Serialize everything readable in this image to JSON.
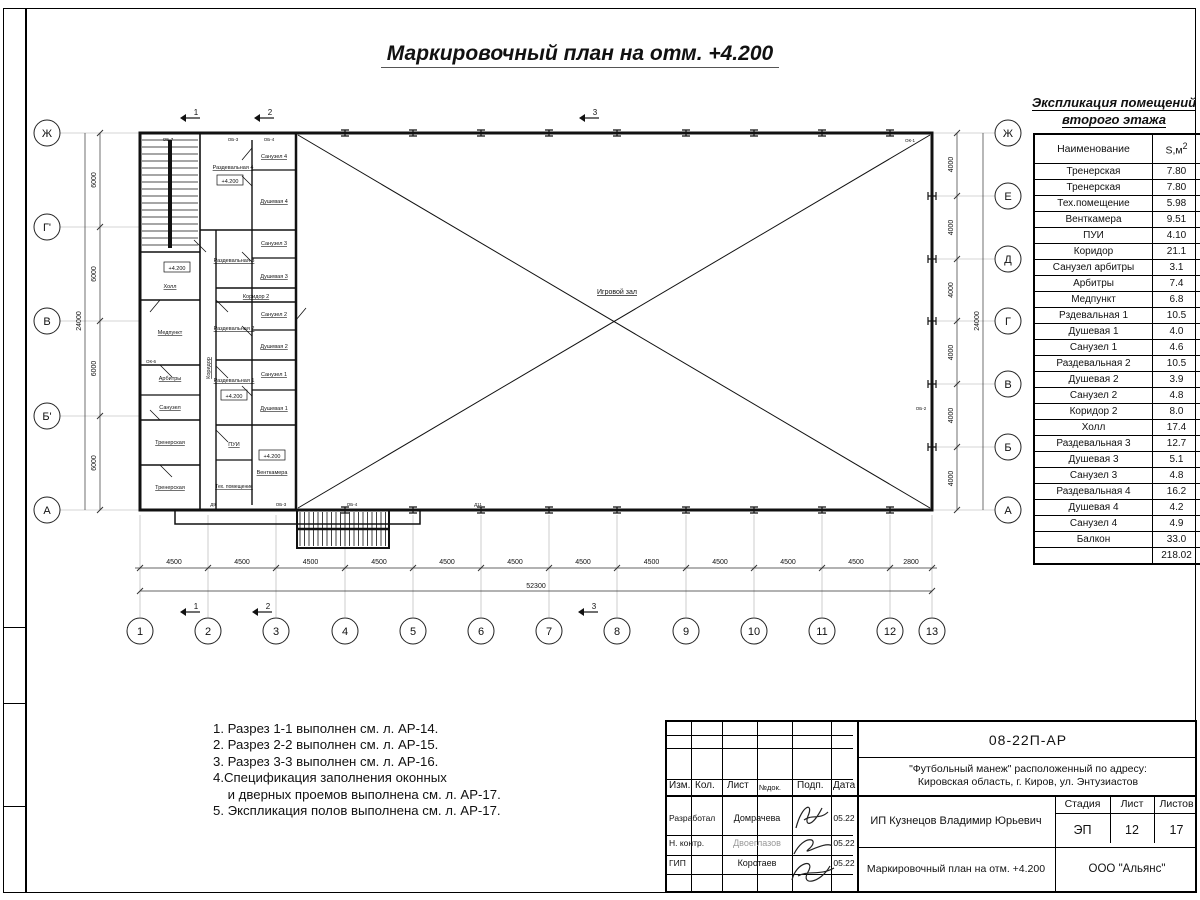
{
  "title": "Маркировочный план на отм. +4.200",
  "plan": {
    "hall_label": "Игровой зал",
    "elevation": "+4.200",
    "rooms": {
      "razd4": "Раздевальная 4",
      "san4": "Санузел 4",
      "dush4": "Душевая 4",
      "razd3": "Раздевальная 3",
      "san3": "Санузел 3",
      "dush3": "Душевая 3",
      "koridor2": "Коридор 2",
      "razd2": "Раздевальная 2",
      "san2": "Санузел 2",
      "dush2": "Душевая 2",
      "razd1": "Раздевальная 1",
      "san1": "Санузел 1",
      "dush1": "Душевая 1",
      "holl": "Холл",
      "medpunkt": "Медпункт",
      "arbitry": "Арбитры",
      "sanuzel": "Санузел",
      "trener1": "Тренерская",
      "trener2": "Тренерская",
      "koridor": "Коридор",
      "pui": "ПУИ",
      "teh": "Тех. помещение",
      "ventkamera": "Венткамера"
    },
    "marks": {
      "m1": "ОБ-7",
      "m2": "ОБ-3",
      "m3": "ОБ-4",
      "m4": "ОК-1",
      "m5": "ОБ-2",
      "m6": "ОК-6",
      "m7": "Д9",
      "m8": "ОБ-3",
      "m9": "ОБ-4",
      "m10": "Д11"
    },
    "axes_bottom": [
      "1",
      "2",
      "3",
      "4",
      "5",
      "6",
      "7",
      "8",
      "9",
      "10",
      "11",
      "12",
      "13"
    ],
    "axes_left": [
      "Ж",
      "Г'",
      "В",
      "Б'",
      "А"
    ],
    "axes_right": [
      "Ж",
      "Е",
      "Д",
      "Г",
      "В",
      "Б",
      "А"
    ],
    "dims_bottom": [
      "4500",
      "4500",
      "4500",
      "4500",
      "4500",
      "4500",
      "4500",
      "4500",
      "4500",
      "4500",
      "4500",
      "2800"
    ],
    "dim_total_bottom": "52300",
    "dims_left": [
      "6000",
      "6000",
      "6000",
      "6000"
    ],
    "dim_total_left": "24000",
    "dims_right": [
      "4000",
      "4000",
      "4000",
      "4000",
      "4000",
      "4000"
    ],
    "dim_total_right": "24000",
    "section_flags": [
      "1",
      "2",
      "3"
    ]
  },
  "explication": {
    "title1": "Экспликация помещений",
    "title2": "второго этажа",
    "col_name": "Наименование",
    "col_area_base": "S,м",
    "col_area_sup": "2",
    "rows": [
      [
        "Тренерская",
        "7.80"
      ],
      [
        "Тренерская",
        "7.80"
      ],
      [
        "Тех.помещение",
        "5.98"
      ],
      [
        "Венткамера",
        "9.51"
      ],
      [
        "ПУИ",
        "4.10"
      ],
      [
        "Коридор",
        "21.1"
      ],
      [
        "Санузел арбитры",
        "3.1"
      ],
      [
        "Арбитры",
        "7.4"
      ],
      [
        "Медпункт",
        "6.8"
      ],
      [
        "Рздевальная 1",
        "10.5"
      ],
      [
        "Душевая 1",
        "4.0"
      ],
      [
        "Санузел 1",
        "4.6"
      ],
      [
        "Раздевальная 2",
        "10.5"
      ],
      [
        "Душевая 2",
        "3.9"
      ],
      [
        "Санузел 2",
        "4.8"
      ],
      [
        "Коридор 2",
        "8.0"
      ],
      [
        "Холл",
        "17.4"
      ],
      [
        "Раздевальная 3",
        "12.7"
      ],
      [
        "Душевая 3",
        "5.1"
      ],
      [
        "Санузел 3",
        "4.8"
      ],
      [
        "Раздевальная 4",
        "16.2"
      ],
      [
        "Душевая 4",
        "4.2"
      ],
      [
        "Санузел 4",
        "4.9"
      ],
      [
        "Балкон",
        "33.0"
      ]
    ],
    "total": "218.02"
  },
  "notes": [
    "1. Разрез 1-1 выполнен см. л. АР-14.",
    "2. Разрез 2-2 выполнен см. л. АР-15.",
    "3. Разрез 3-3 выполнен см. л. АР-16.",
    "4.Спецификация заполнения оконных",
    "    и дверных проемов выполнена см. л. АР-17.",
    "5. Экспликация полов выполнена см. л. АР-17."
  ],
  "titleblock": {
    "doc_number": "08-22П-АР",
    "project_line1": "\"Футбольный манеж\" расположенный по адресу:",
    "project_line2": "Кировская область, г. Киров, ул. Энтузиастов",
    "col_izm": "Изм.",
    "col_kol": "Кол.",
    "col_list": "Лист",
    "col_ndok": "№док.",
    "col_podp": "Подп.",
    "col_data": "Дата",
    "role1": "Разработал",
    "name1": "Домрачева",
    "date1": "05.22",
    "role2": "Н. контр.",
    "name2": "Двоеглазов",
    "date2": "05.22",
    "role3": "ГИП",
    "name3": "Коротаев",
    "date3": "05.22",
    "client": "ИП Кузнецов Владимир Юрьевич",
    "stage_label": "Стадия",
    "stage": "ЭП",
    "sheet_label": "Лист",
    "sheet": "12",
    "sheets_label": "Листов",
    "sheets": "17",
    "drawing_name": "Маркировочный план на отм. +4.200",
    "company": "ООО \"Альянс\""
  }
}
